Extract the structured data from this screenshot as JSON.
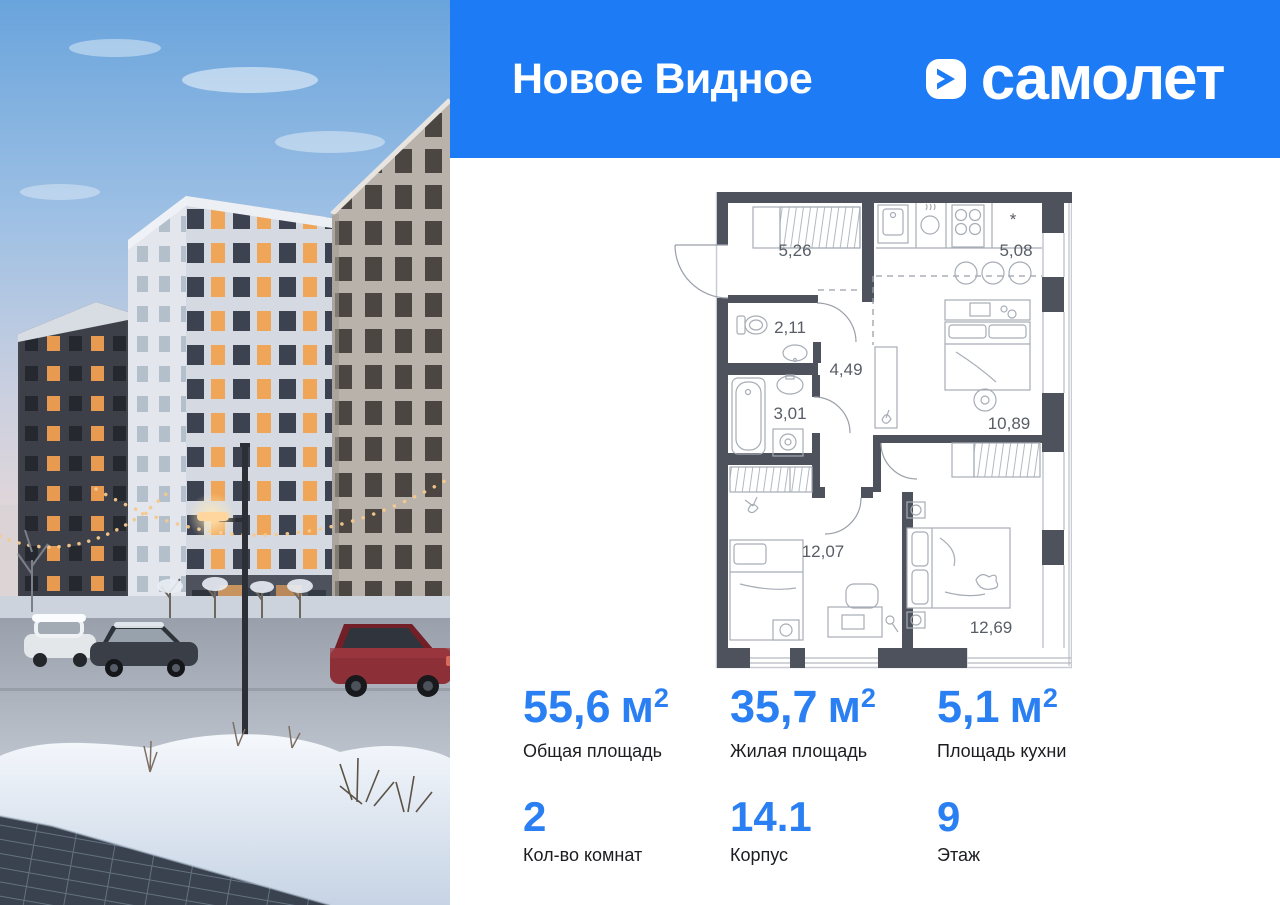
{
  "header": {
    "project_name": "Новое Видное",
    "brand_name": "самолет"
  },
  "floor_plan": {
    "kitchen_symbol": "*",
    "rooms": [
      {
        "name": "hallway",
        "area": "5,26"
      },
      {
        "name": "kitchen",
        "area": "5,08"
      },
      {
        "name": "wc",
        "area": "2,11"
      },
      {
        "name": "corridor",
        "area": "4,49"
      },
      {
        "name": "bathroom",
        "area": "3,01"
      },
      {
        "name": "living-room",
        "area": "10,89"
      },
      {
        "name": "bedroom-1",
        "area": "12,07"
      },
      {
        "name": "bedroom-2",
        "area": "12,69"
      }
    ]
  },
  "stats": {
    "row1": [
      {
        "value": "55,6",
        "unit": "м",
        "sup": "2",
        "label": "Общая площадь"
      },
      {
        "value": "35,7",
        "unit": "м",
        "sup": "2",
        "label": "Жилая площадь"
      },
      {
        "value": "5,1",
        "unit": "м",
        "sup": "2",
        "label": "Площадь кухни"
      }
    ],
    "row2": [
      {
        "value": "2",
        "label": "Кол-во комнат"
      },
      {
        "value": "14.1",
        "label": "Корпус"
      },
      {
        "value": "9",
        "label": "Этаж"
      }
    ]
  },
  "colors": {
    "header_bg": "#1d7cf5",
    "accent": "#2a80f3",
    "wall": "#4d525c",
    "plan_label": "#585d66",
    "text_dark": "#1c1d20"
  }
}
